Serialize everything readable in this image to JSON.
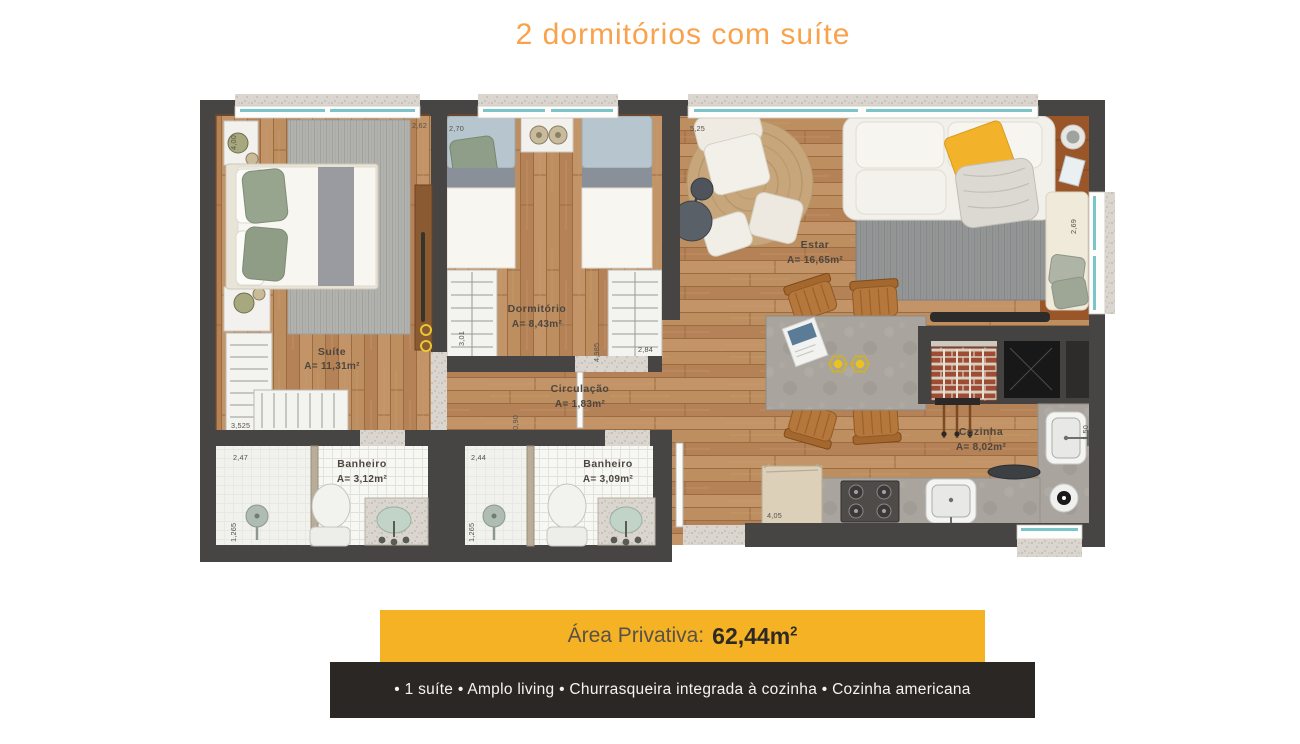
{
  "title": "2 dormitórios com suíte",
  "area_banner": {
    "label": "Área Privativa:",
    "value": "62,44m",
    "sup": "2"
  },
  "features_banner": {
    "text": "• 1 suíte • Amplo living • Churrasqueira integrada à cozinha • Cozinha americana"
  },
  "rooms": {
    "suite": {
      "name": "Suíte",
      "area": "A= 11,31m²"
    },
    "dormitorio": {
      "name": "Dormitório",
      "area": "A= 8,43m²"
    },
    "estar": {
      "name": "Estar",
      "area": "A= 16,65m²"
    },
    "circulacao": {
      "name": "Circulação",
      "area": "A= 1,83m²"
    },
    "banheiro1": {
      "name": "Banheiro",
      "area": "A= 3,12m²"
    },
    "banheiro2": {
      "name": "Banheiro",
      "area": "A= 3,09m²"
    },
    "cozinha": {
      "name": "Cozinha",
      "area": "A= 8,02m²"
    }
  },
  "dimensions": {
    "suite_width": "4,00",
    "suite_top": "2,62",
    "dorm_top": "2,70",
    "estar_top": "5,25",
    "varanda_side": "2,69",
    "dorm_closet": "3,01",
    "dorm_closet_right": "2,84",
    "circ_length": "4,985",
    "circ_width": "0,90",
    "suite_closet": "3,525",
    "bath1_top": "2,47",
    "bath1_side": "1,265",
    "bath2_top": "2,44",
    "bath2_side": "1,265",
    "kitchen_length": "4,05",
    "kitchen_side": "1,50"
  },
  "colors": {
    "accent_orange": "#F9A24B",
    "banner_yellow": "#F5B224",
    "banner_dark": "#2B2724",
    "wall": "#474444",
    "wood": "#BA8C5E",
    "window_glass": "#79C5C9"
  }
}
